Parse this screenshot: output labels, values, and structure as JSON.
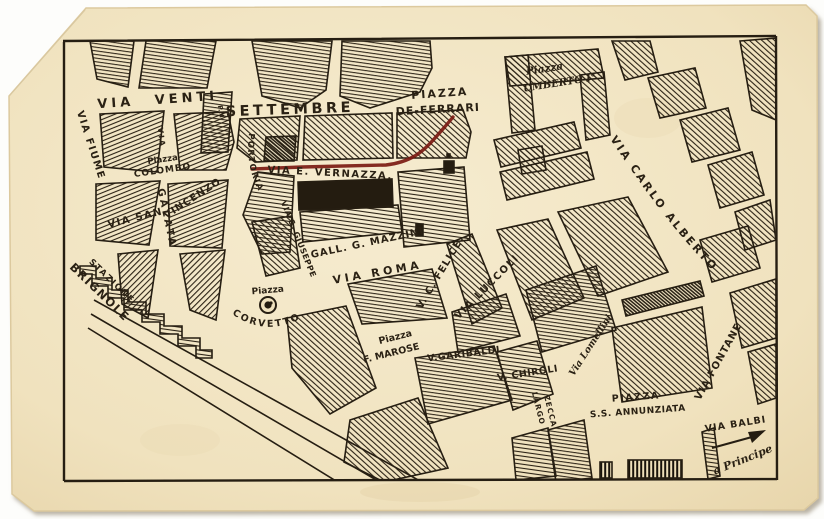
{
  "postcard": {
    "colors": {
      "page_background": "#fdfdfb",
      "paper": "#f1e5c4",
      "paper_edge": "#e2d0a6",
      "ink": "#261e12",
      "route_red": "#7b1a12"
    },
    "labels": {
      "via_venti": "VIA VENTI",
      "settembre": "SETTEMBRE",
      "via_fiume": "VIA FIUME",
      "piazza_colombo_line1": "Piazza",
      "piazza_colombo_line2": "COLOMBO",
      "via_vertical": "VIA",
      "via_galata": "GALATA",
      "via_san": "VIA SAN",
      "vincenzo": "VINCENZO",
      "stazione": "STAZIONE",
      "brignole": "BRIGNOLE",
      "portoria": "PORTORIA",
      "via_s_giuseppe": "VIA S. GIUSEPPE",
      "ponte": "P.M.",
      "via_e_vernazza": "VIA E. VERNAZZA.",
      "piazza_de_ferrari_line1": "PIAZZA",
      "piazza_de_ferrari_line2": "DE-FERRARI",
      "piazza_umberto_line1": "Piazza",
      "piazza_umberto_line2": "UMBERTO I°",
      "via_carlo_alberto": "VIA CARLO ALBERTO",
      "gall_g_mazzini": "GALL. G. MAZZINI",
      "via_roma": "VIA ROMA",
      "piazza_corvetto_line1": "Piazza",
      "piazza_corvetto_line2": "CORVETTO",
      "v_c_felice": "V. C. FELICE.",
      "via_luccoli": "VIA LUCCOLI",
      "piazza_marose_line1": "Piazza",
      "piazza_marose_line2": "F. MAROSE",
      "v_garibaldi": "V.GARIBALDI",
      "v_chiroli": "V. CHIROLI",
      "via_lomellini": "Via Lomellini",
      "largo": "LARGO",
      "zecca": "ZECCA",
      "piazza_annunziata_line1": "PIAZZA",
      "piazza_annunziata_line2": "S.S. ANNUNZIATA",
      "via_fontane": "VIA FONTANE",
      "via_balbi": "VIA BALBI",
      "a_principe": "a Principe"
    }
  }
}
